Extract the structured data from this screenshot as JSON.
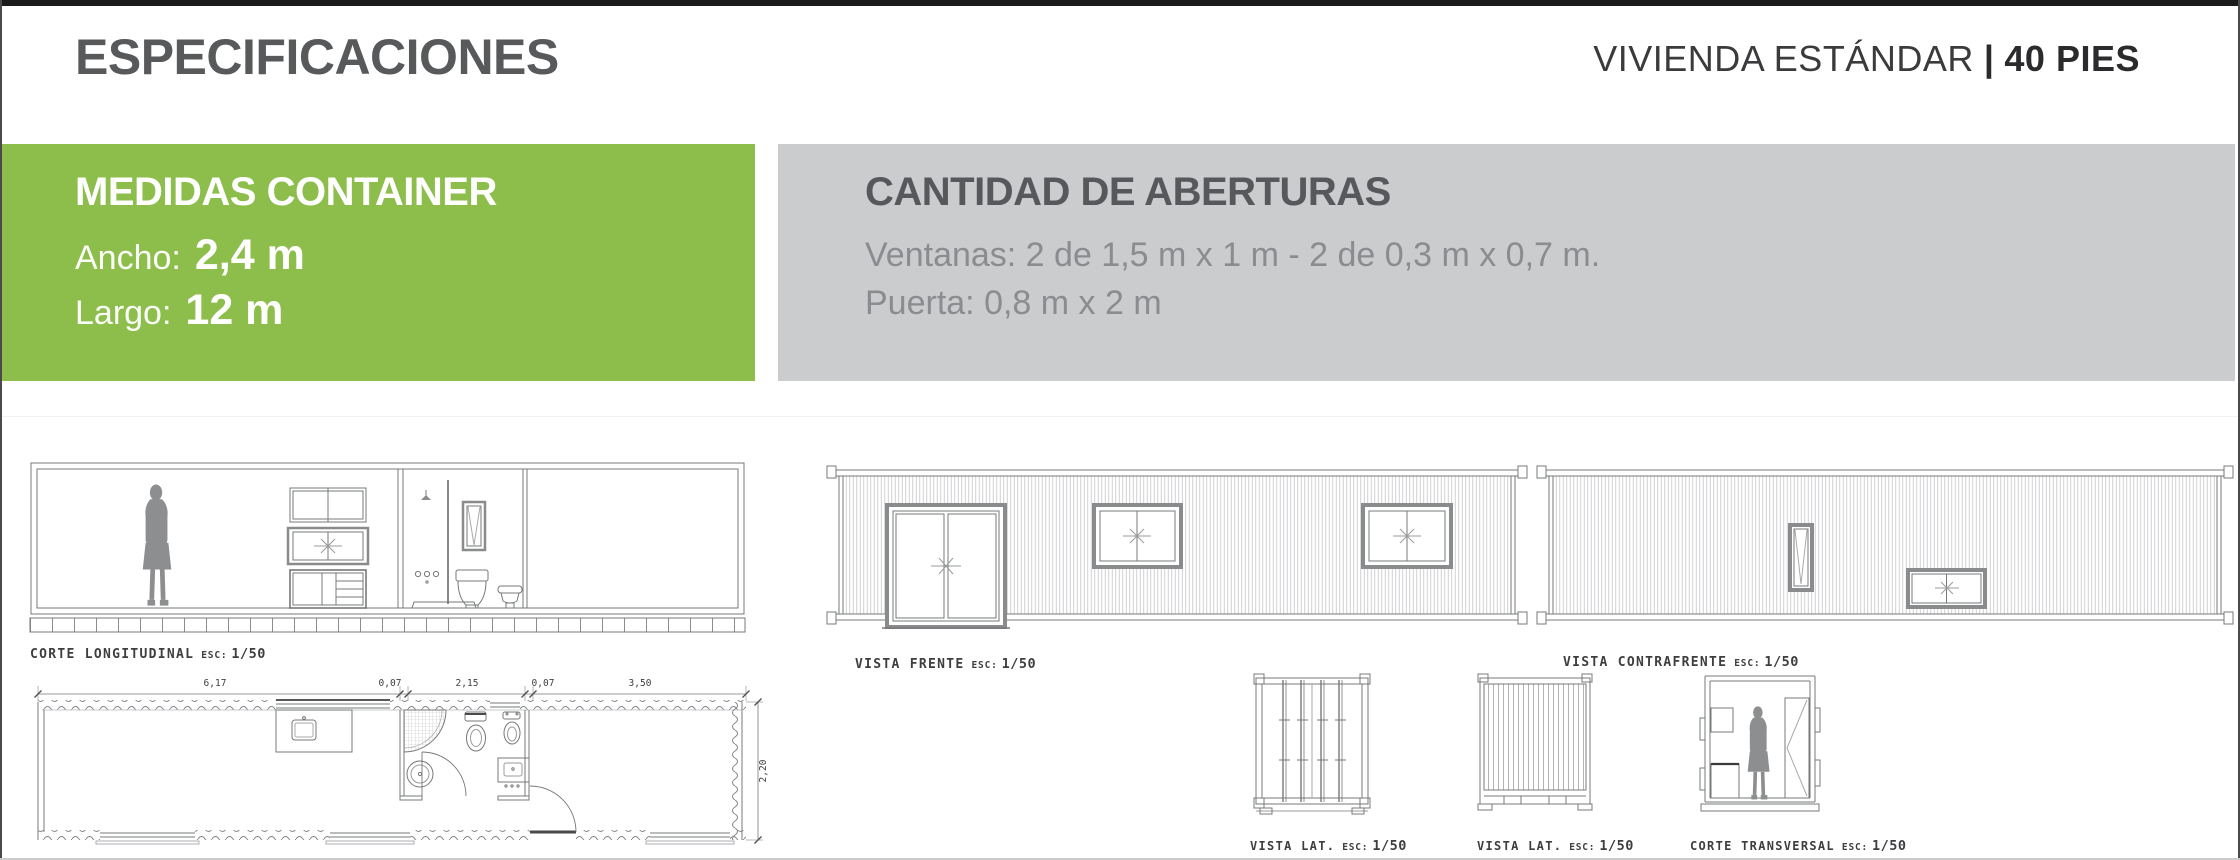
{
  "header": {
    "title": "ESPECIFICACIONES",
    "subtitle_left": "VIVIENDA ESTÁNDAR",
    "subtitle_divider": "|",
    "subtitle_right": "40 PIES"
  },
  "panels": {
    "medidas": {
      "bg_color": "#8DBE4B",
      "title": "MEDIDAS CONTAINER",
      "rows": [
        {
          "label": "Ancho:",
          "value": "2,4 m"
        },
        {
          "label": "Largo:",
          "value": "12 m"
        }
      ]
    },
    "aberturas": {
      "bg_color": "#CBCCCD",
      "title": "CANTIDAD DE ABERTURAS",
      "lines": [
        "Ventanas: 2 de 1,5 m x 1 m - 2 de 0,3 m x 0,7 m.",
        "Puerta: 0,8 m x 2 m"
      ]
    }
  },
  "drawings": {
    "corte_longitudinal": {
      "name": "CORTE LONGITUDINAL",
      "esc": "ESC:",
      "scale": "1/50"
    },
    "vista_frente": {
      "name": "VISTA FRENTE",
      "esc": "ESC:",
      "scale": "1/50"
    },
    "vista_contrafrente": {
      "name": "VISTA CONTRAFRENTE",
      "esc": "ESC:",
      "scale": "1/50"
    },
    "vista_lat_1": {
      "name": "VISTA LAT.",
      "esc": "ESC:",
      "scale": "1/50"
    },
    "vista_lat_2": {
      "name": "VISTA LAT.",
      "esc": "ESC:",
      "scale": "1/50"
    },
    "corte_transversal": {
      "name": "CORTE TRANSVERSAL",
      "esc": "ESC:",
      "scale": "1/50"
    },
    "planta": {
      "dims_top": [
        "6,17",
        "0,07",
        "2,15",
        "0,07",
        "3,50"
      ],
      "dim_right": "2,20"
    }
  }
}
